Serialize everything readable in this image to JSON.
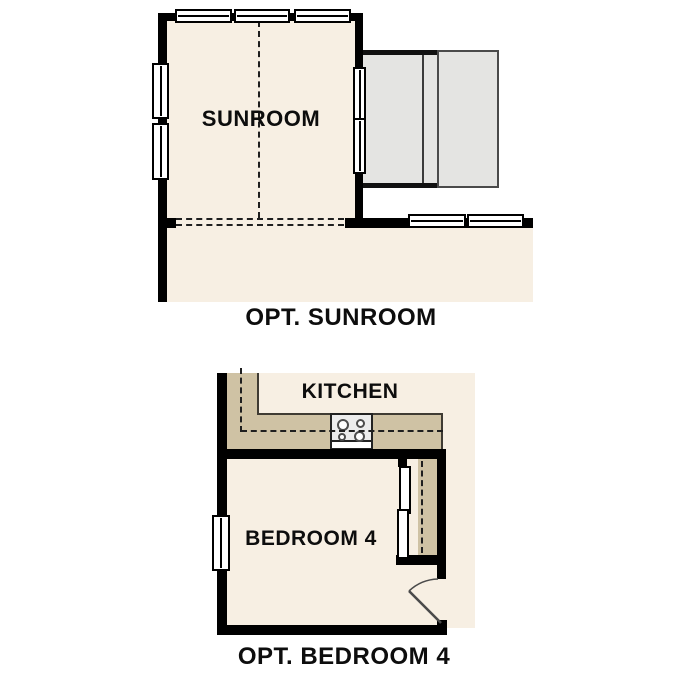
{
  "colors": {
    "page_bg": "#ffffff",
    "floor": "#f7efe3",
    "wall": "#000000",
    "counter": "#cfc2a4",
    "counter_edge": "#3f3b33",
    "patio": "#e4e4e2",
    "patio_edge": "#4a4a4a",
    "appliance": "#ececec",
    "dash": "#1f1f1f",
    "door": "#4a4a4a",
    "text": "#0d0d0d"
  },
  "icons": {
    "window": "double-line-window-shape",
    "cooktop": "four-burner-cooktop-shape",
    "door_swing": "quarter-arc-door-swing-shape",
    "sliding_door": "bypass-sliding-panels-shape"
  },
  "plans": {
    "sunroom": {
      "room_label": "SUNROOM",
      "caption": "OPT. SUNROOM"
    },
    "bedroom": {
      "kitchen_label": "KITCHEN",
      "room_label": "BEDROOM 4",
      "caption": "OPT. BEDROOM 4"
    }
  }
}
